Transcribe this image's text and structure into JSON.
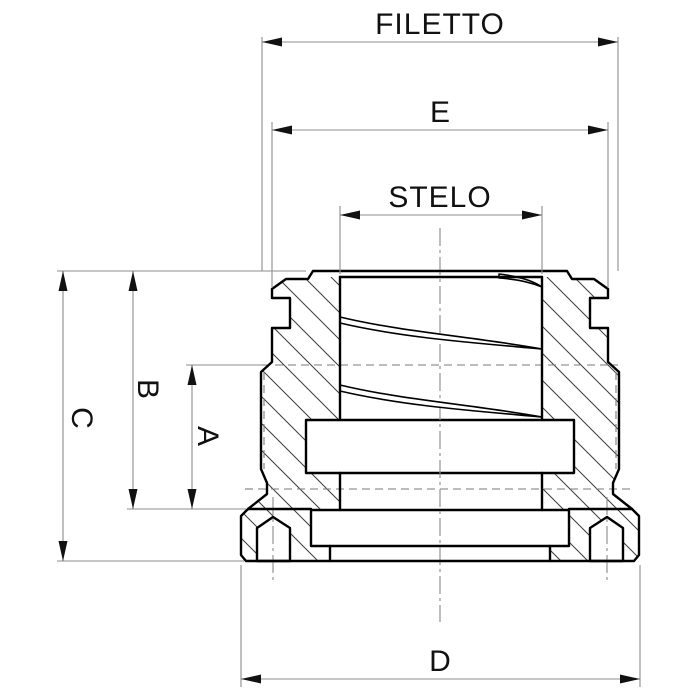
{
  "drawing": {
    "type": "technical-section-drawing",
    "subject": "threaded insert cross-section with dimension callouts",
    "labels": {
      "filetto": "FILETTO",
      "e": "E",
      "stelo": "STELO",
      "a": "A",
      "b": "B",
      "c": "C",
      "d": "D"
    },
    "colors": {
      "background": "#ffffff",
      "outline": "#000000",
      "dimension_line": "#8c8c8c",
      "centerline": "#8a8a8a",
      "hidden_line": "#7a7a7a",
      "hatch": "#3c3c3c",
      "arrow": "#111111",
      "text": "#111111"
    }
  }
}
